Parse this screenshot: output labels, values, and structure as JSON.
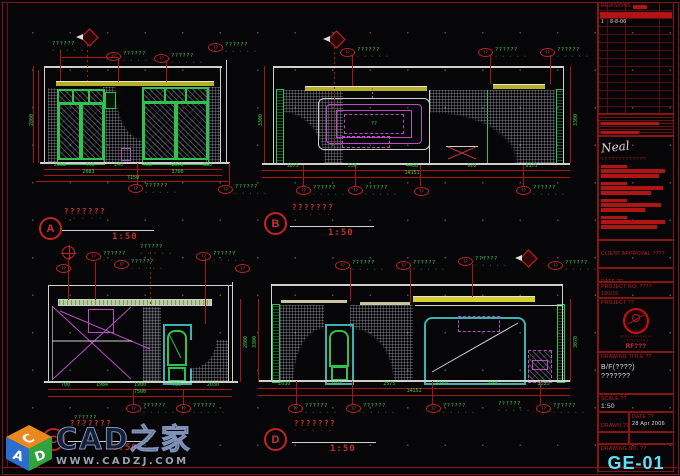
{
  "annotations": {
    "tag_code": "??",
    "leader_text": "??????",
    "leader_marks": "▵ ▵ ▵ ▵ ▵",
    "small_green": "??"
  },
  "elevations": [
    {
      "id": "A",
      "title": "???????",
      "scale": "1:50",
      "dims_bottom_row1": [
        "2088",
        "440",
        "240",
        "768",
        "2570",
        "880"
      ],
      "dims_bottom_row2": [
        "2083",
        "3760"
      ],
      "dims_bottom_total": "7150",
      "dim_side": "2800"
    },
    {
      "id": "B",
      "title": "???????",
      "scale": "1:50",
      "dims_bottom_row1": [
        "1875",
        "530",
        "4468",
        "920",
        "6375"
      ],
      "dims_bottom_row2": [
        "14151"
      ],
      "dim_side": "3300",
      "dim_side2": "3300"
    },
    {
      "id": "C",
      "title": "???????",
      "scale": "1:50",
      "dims_bottom_row1": [
        "700",
        "1984",
        "1900",
        "750",
        "2030"
      ],
      "dims_bottom_row2": [
        "7500"
      ],
      "dim_side": "2800"
    },
    {
      "id": "D",
      "title": "???????",
      "scale": "1:50",
      "dims_bottom_row1": [
        "2030",
        "1075",
        "2575",
        "4150",
        "500",
        "2225"
      ],
      "dims_bottom_row2": [
        "14151"
      ],
      "dim_side": "3300",
      "dim_side2": "3070"
    }
  ],
  "titleblock": {
    "revisions_label": "REVISIONS",
    "rev_no": "1",
    "rev_date": "8-8-06",
    "signature": "Neal",
    "company_line": "?????????????",
    "client_approval_label": "CLIENT APPROVAL ????",
    "date_label": "DATE ??",
    "project_no_label": "PROJECT NO. ????",
    "project_no_value": "100/19",
    "project_label": "PROJECT ??",
    "seal_caption1": "?????????????",
    "seal_caption2": "??????????",
    "seal_caption3": "RF???",
    "drawing_title_label": "DRAWING TITLE ??",
    "drawing_title_line1": "B/F(????)",
    "drawing_title_line2": "???????",
    "scale_label": "SCALE ??",
    "scale_value": "1:50",
    "drawn_label": "DRAWN ??",
    "date2_label": "DATE ??",
    "drawn_date": "28 Apr 2006",
    "checked_label": "CHECKED ??",
    "date3_label": "DATE ??",
    "drawing_no_label": "DRAWING NO. ??",
    "drawing_no": "GE-01"
  },
  "watermark": {
    "cube_letters": [
      "C",
      "A",
      "D"
    ],
    "brand": "CAD之家",
    "url": "WWW.CADZJ.COM"
  },
  "colors": {
    "accent_green": "#2ec24e",
    "accent_red": "#c22020",
    "accent_cyan": "#62dff2",
    "accent_magenta": "#b84cc4",
    "accent_yellow": "#c8c230"
  }
}
